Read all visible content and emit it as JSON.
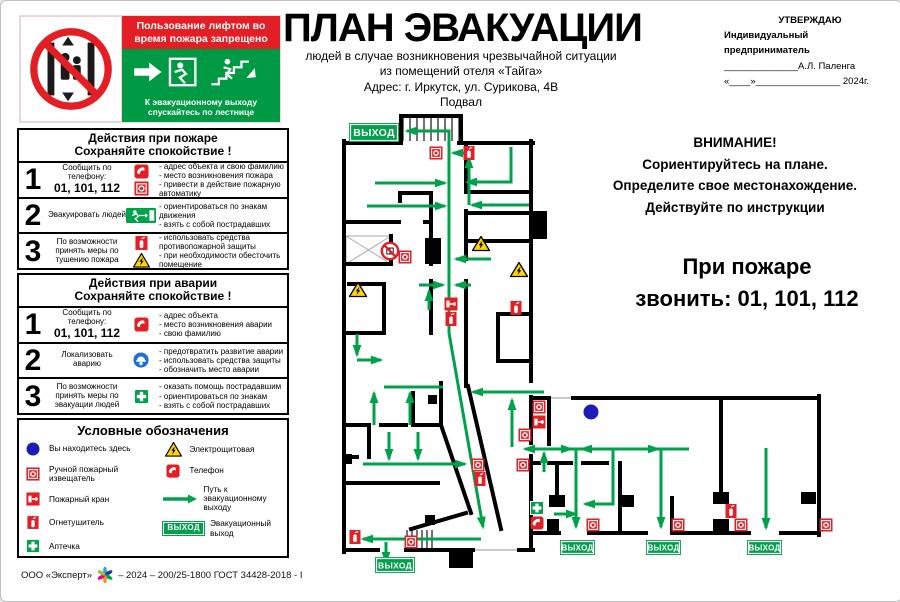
{
  "header": {
    "title": "ПЛАН ЭВАКУАЦИИ",
    "subtitle_lines": [
      "людей в случае возникновения чрезвычайной ситуации",
      "из помещений отеля «Тайга»",
      "Адрес: г. Иркутск, ул. Сурикова, 4В",
      "Подвал"
    ],
    "approve": {
      "line1": "УТВЕРЖДАЮ",
      "line2": "Индивидуальный предприниматель",
      "line3": "______________А.Л. Паленга",
      "line4": "«____»________________ 2024г."
    }
  },
  "elevator_sign": {
    "ban_text": "Пользование лифтом во время пожара запрещено",
    "exit_text": "К эвакуационному выходу спускайтесь по лестнице"
  },
  "panels": {
    "fire": {
      "title1": "Действия при пожаре",
      "title2": "Сохраняйте спокойствие !",
      "rows": [
        {
          "num": "1",
          "label": "Сообщить по телефону:",
          "phones": "01, 101, 112",
          "icons": [
            "phone-icon",
            "fire-alarm-icon"
          ],
          "bullets": [
            "- адрес объекта и свою фамилию",
            "- место возникновения пожара",
            "- привести в действие пожарную автоматику"
          ]
        },
        {
          "num": "2",
          "label": "Эвакуировать людей",
          "icons": [
            "exit-man-icon"
          ],
          "bullets": [
            "- ориентироваться по знакам движения",
            "- взять с собой пострадавших",
            ""
          ]
        },
        {
          "num": "3",
          "label": "По возможности принять меры по тушению пожара",
          "icons": [
            "extinguisher-icon",
            "electric-warning-icon"
          ],
          "bullets": [
            "- использовать средства противопожарной защиты",
            "- при необходимости обесточить помещение",
            ""
          ]
        }
      ]
    },
    "accident": {
      "title1": "Действия при аварии",
      "title2": "Сохраняйте спокойствие !",
      "rows": [
        {
          "num": "1",
          "label": "Сообщить по телефону:",
          "phones": "01, 101, 112",
          "icons": [
            "phone-icon"
          ],
          "bullets": [
            "- адрес объекта",
            "- место возникновения аварии",
            "- свою фамилию"
          ]
        },
        {
          "num": "2",
          "label": "Локализовать аварию",
          "icons": [
            "protective-gear-icon"
          ],
          "bullets": [
            "- предотвратить развитие аварии",
            "- использовать средства защиты",
            "- обозначить место аварии"
          ]
        },
        {
          "num": "3",
          "label": "По возможности принять меры по эвакуации людей",
          "icons": [
            "first-aid-icon"
          ],
          "bullets": [
            "- оказать помощь пострадавшим",
            "- ориентироваться по знакам",
            "- взять с собой пострадавших"
          ]
        }
      ]
    }
  },
  "legend": {
    "title": "Условные обозначения",
    "badge_label": "ВЫХОД",
    "left": [
      {
        "icon": "you-are-here-icon",
        "label": "Вы находитесь здесь"
      },
      {
        "icon": "fire-alarm-icon",
        "label": "Ручной пожарный извещатель"
      },
      {
        "icon": "fire-hose-icon",
        "label": "Пожарный кран"
      },
      {
        "icon": "extinguisher-icon",
        "label": "Огнетушитель"
      },
      {
        "icon": "first-aid-icon",
        "label": "Аптечка"
      }
    ],
    "right": [
      {
        "icon": "electric-warning-icon",
        "label": "Электрощитовая"
      },
      {
        "icon": "phone-icon",
        "label": "Телефон"
      },
      {
        "icon": "route-arrow-icon",
        "label": "Путь к эвакуационному выходу"
      },
      {
        "icon": "exit-badge-icon",
        "label": "Эвакуационный выход"
      }
    ]
  },
  "attention": {
    "lines": [
      "ВНИМАНИЕ!",
      "Сориентируйтесь на плане.",
      "Определите свое местонахождение.",
      "Действуйте по инструкции"
    ]
  },
  "emergency_call": {
    "line1": "При пожаре",
    "line2": "звонить: 01, 101, 112"
  },
  "footer": {
    "org": "ООО «Эксперт»",
    "code": "– 2024 – 200/25-1800 ГОСТ 34428-2018 - I"
  },
  "colors": {
    "green": "#00A14B",
    "red": "#E31E24",
    "blue": "#1C1CB8",
    "yellow": "#FFD500"
  },
  "plan": {
    "badge_label": "ВЫХОД",
    "walls": [
      [
        343,
        142,
        400,
        142
      ],
      [
        458,
        142,
        532,
        142
      ],
      [
        343,
        140,
        343,
        551
      ],
      [
        343,
        549,
        377,
        549
      ],
      [
        405,
        549,
        472,
        549
      ],
      [
        518,
        549,
        532,
        549
      ],
      [
        530,
        140,
        530,
        380
      ],
      [
        530,
        396,
        530,
        442
      ],
      [
        530,
        455,
        530,
        549
      ],
      [
        400,
        115,
        400,
        142
      ],
      [
        400,
        115,
        460,
        115
      ],
      [
        460,
        115,
        460,
        142
      ],
      [
        530,
        397,
        548,
        397
      ],
      [
        572,
        397,
        818,
        397
      ],
      [
        818,
        395,
        818,
        534
      ],
      [
        532,
        532,
        558,
        532
      ],
      [
        588,
        532,
        645,
        532
      ],
      [
        672,
        532,
        748,
        532
      ],
      [
        780,
        532,
        818,
        532
      ],
      [
        548,
        397,
        548,
        443
      ],
      [
        619,
        462,
        619,
        532
      ],
      [
        720,
        397,
        720,
        497
      ],
      [
        671,
        497,
        671,
        532
      ],
      [
        530,
        462,
        538,
        462
      ],
      [
        548,
        462,
        570,
        462
      ],
      [
        582,
        462,
        606,
        462
      ],
      [
        556,
        462,
        556,
        496
      ],
      [
        399,
        192,
        430,
        192
      ],
      [
        345,
        221,
        398,
        221
      ],
      [
        424,
        221,
        430,
        221
      ],
      [
        399,
        192,
        399,
        200
      ],
      [
        430,
        192,
        430,
        263
      ],
      [
        430,
        280,
        430,
        332
      ],
      [
        465,
        142,
        465,
        190
      ],
      [
        465,
        210,
        465,
        258
      ],
      [
        465,
        280,
        465,
        385
      ],
      [
        465,
        191,
        530,
        191
      ],
      [
        465,
        212,
        530,
        212
      ],
      [
        465,
        240,
        530,
        240
      ],
      [
        497,
        313,
        530,
        313
      ],
      [
        497,
        313,
        497,
        360
      ],
      [
        497,
        360,
        530,
        360
      ],
      [
        345,
        263,
        390,
        263
      ],
      [
        390,
        235,
        390,
        263
      ],
      [
        348,
        283,
        383,
        283
      ],
      [
        383,
        283,
        383,
        332
      ],
      [
        345,
        332,
        383,
        332
      ],
      [
        345,
        424,
        368,
        424
      ],
      [
        380,
        424,
        405,
        424
      ],
      [
        413,
        424,
        440,
        424
      ],
      [
        368,
        424,
        368,
        456
      ],
      [
        412,
        392,
        412,
        424
      ],
      [
        440,
        382,
        440,
        424
      ],
      [
        345,
        456,
        356,
        456
      ],
      [
        345,
        482,
        437,
        482
      ],
      [
        440,
        424,
        470,
        512
      ],
      [
        467,
        385,
        500,
        528
      ],
      [
        410,
        528,
        465,
        512
      ]
    ],
    "thin": [
      [
        474,
        549,
        516,
        549
      ],
      [
        550,
        397,
        570,
        397
      ]
    ],
    "blocks": [
      [
        530,
        210,
        16,
        28
      ],
      [
        424,
        237,
        16,
        26
      ],
      [
        427,
        394,
        9,
        9
      ],
      [
        424,
        514,
        10,
        10
      ],
      [
        448,
        549,
        24,
        18
      ],
      [
        548,
        494,
        16,
        12
      ],
      [
        619,
        494,
        14,
        12
      ],
      [
        712,
        491,
        16,
        12
      ],
      [
        712,
        518,
        16,
        13
      ],
      [
        800,
        491,
        15,
        12
      ],
      [
        546,
        518,
        12,
        14
      ],
      [
        343,
        453,
        8,
        10
      ]
    ],
    "hatches": [
      [
        402,
        117,
        56,
        23,
        7
      ],
      [
        406,
        529,
        26,
        19,
        5
      ]
    ],
    "xboxes": [
      [
        345,
        235,
        45,
        28
      ]
    ],
    "routes": [
      {
        "p": [
          [
            448,
            332
          ],
          [
            448,
            130
          ],
          [
            406,
            130
          ]
        ],
        "a": 1
      },
      {
        "p": [
          [
            468,
            204
          ],
          [
            468,
            157
          ]
        ],
        "a": 1
      },
      {
        "p": [
          [
            528,
            204
          ],
          [
            471,
            204
          ]
        ],
        "a": 1
      },
      {
        "p": [
          [
            466,
            152
          ],
          [
            452,
            152
          ]
        ],
        "a": 1
      },
      {
        "p": [
          [
            510,
            146
          ],
          [
            510,
            181
          ],
          [
            466,
            181
          ]
        ],
        "a": 1
      },
      {
        "p": [
          [
            374,
            182
          ],
          [
            444,
            182
          ]
        ],
        "a": 1
      },
      {
        "p": [
          [
            366,
            205
          ],
          [
            444,
            205
          ]
        ],
        "a": 1
      },
      {
        "p": [
          [
            490,
            258
          ],
          [
            455,
            258
          ]
        ],
        "a": 1
      },
      {
        "p": [
          [
            470,
            284
          ],
          [
            455,
            284
          ]
        ],
        "a": 1
      },
      {
        "p": [
          [
            418,
            284
          ],
          [
            442,
            284
          ]
        ],
        "a": 1
      },
      {
        "p": [
          [
            428,
            309
          ],
          [
            428,
            290
          ]
        ],
        "a": 1
      },
      {
        "p": [
          [
            356,
            333
          ],
          [
            356,
            354
          ]
        ],
        "a": 1
      },
      {
        "p": [
          [
            356,
            359
          ],
          [
            380,
            359
          ]
        ],
        "a": 1
      },
      {
        "p": [
          [
            383,
            386
          ],
          [
            442,
            386
          ]
        ],
        "a": 0
      },
      {
        "p": [
          [
            373,
            424
          ],
          [
            373,
            392
          ]
        ],
        "a": 1
      },
      {
        "p": [
          [
            409,
            424
          ],
          [
            409,
            392
          ]
        ],
        "a": 1
      },
      {
        "p": [
          [
            388,
            431
          ],
          [
            388,
            458
          ]
        ],
        "a": 1
      },
      {
        "p": [
          [
            417,
            431
          ],
          [
            417,
            458
          ]
        ],
        "a": 1
      },
      {
        "p": [
          [
            362,
            463
          ],
          [
            464,
            463
          ]
        ],
        "a": 1
      },
      {
        "p": [
          [
            448,
            332
          ],
          [
            482,
            526
          ]
        ],
        "a": 1
      },
      {
        "p": [
          [
            480,
            538
          ],
          [
            362,
            538
          ]
        ],
        "a": 1
      },
      {
        "p": [
          [
            385,
            541
          ],
          [
            385,
            561
          ]
        ],
        "a": 1
      },
      {
        "p": [
          [
            511,
            446
          ],
          [
            511,
            399
          ]
        ],
        "a": 1
      },
      {
        "p": [
          [
            543,
            391
          ],
          [
            472,
            391
          ]
        ],
        "a": 1
      },
      {
        "p": [
          [
            688,
            448
          ],
          [
            524,
            448
          ]
        ],
        "a": 1
      },
      {
        "p": [
          [
            548,
            448
          ],
          [
            570,
            448
          ]
        ],
        "a": 1
      },
      {
        "p": [
          [
            600,
            448
          ],
          [
            581,
            448
          ]
        ],
        "a": 1
      },
      {
        "p": [
          [
            642,
            448
          ],
          [
            657,
            448
          ]
        ],
        "a": 1
      },
      {
        "p": [
          [
            543,
            471
          ],
          [
            543,
            452
          ]
        ],
        "a": 1
      },
      {
        "p": [
          [
            575,
            448
          ],
          [
            575,
            526
          ]
        ],
        "a": 1
      },
      {
        "p": [
          [
            612,
            448
          ],
          [
            612,
            503
          ],
          [
            584,
            503
          ]
        ],
        "a": 1
      },
      {
        "p": [
          [
            553,
            513
          ],
          [
            575,
            513
          ]
        ],
        "a": 1
      },
      {
        "p": [
          [
            660,
            448
          ],
          [
            660,
            526
          ]
        ],
        "a": 1
      },
      {
        "p": [
          [
            765,
            447
          ],
          [
            765,
            527
          ]
        ],
        "a": 1
      }
    ],
    "icons": [
      [
        "alarm",
        435,
        152
      ],
      [
        "ext",
        468,
        152
      ],
      [
        "noelev",
        389,
        250
      ],
      [
        "alarm",
        404,
        256
      ],
      [
        "warn",
        480,
        243
      ],
      [
        "warn",
        518,
        269
      ],
      [
        "warn",
        357,
        289
      ],
      [
        "hose",
        450,
        303
      ],
      [
        "ext",
        450,
        318
      ],
      [
        "ext",
        515,
        307
      ],
      [
        "alarm",
        477,
        464
      ],
      [
        "ext",
        479,
        478
      ],
      [
        "alarm",
        522,
        464
      ],
      [
        "ext",
        354,
        536
      ],
      [
        "alarm",
        410,
        541
      ],
      [
        "alarm",
        538,
        406
      ],
      [
        "hose",
        538,
        421
      ],
      [
        "alarm",
        524,
        434
      ],
      [
        "dot",
        590,
        411
      ],
      [
        "aid",
        536,
        507
      ],
      [
        "phone",
        536,
        522
      ],
      [
        "alarm",
        592,
        524
      ],
      [
        "alarm",
        677,
        524
      ],
      [
        "ext",
        730,
        510
      ],
      [
        "alarm",
        740,
        524
      ],
      [
        "alarm",
        825,
        524
      ]
    ],
    "badges": [
      [
        348,
        122,
        50,
        19,
        10.5
      ],
      [
        374,
        556,
        40,
        16,
        8.5
      ],
      [
        559,
        539,
        35,
        15,
        8
      ],
      [
        645,
        539,
        35,
        15,
        8
      ],
      [
        746,
        539,
        35,
        15,
        8
      ]
    ]
  }
}
